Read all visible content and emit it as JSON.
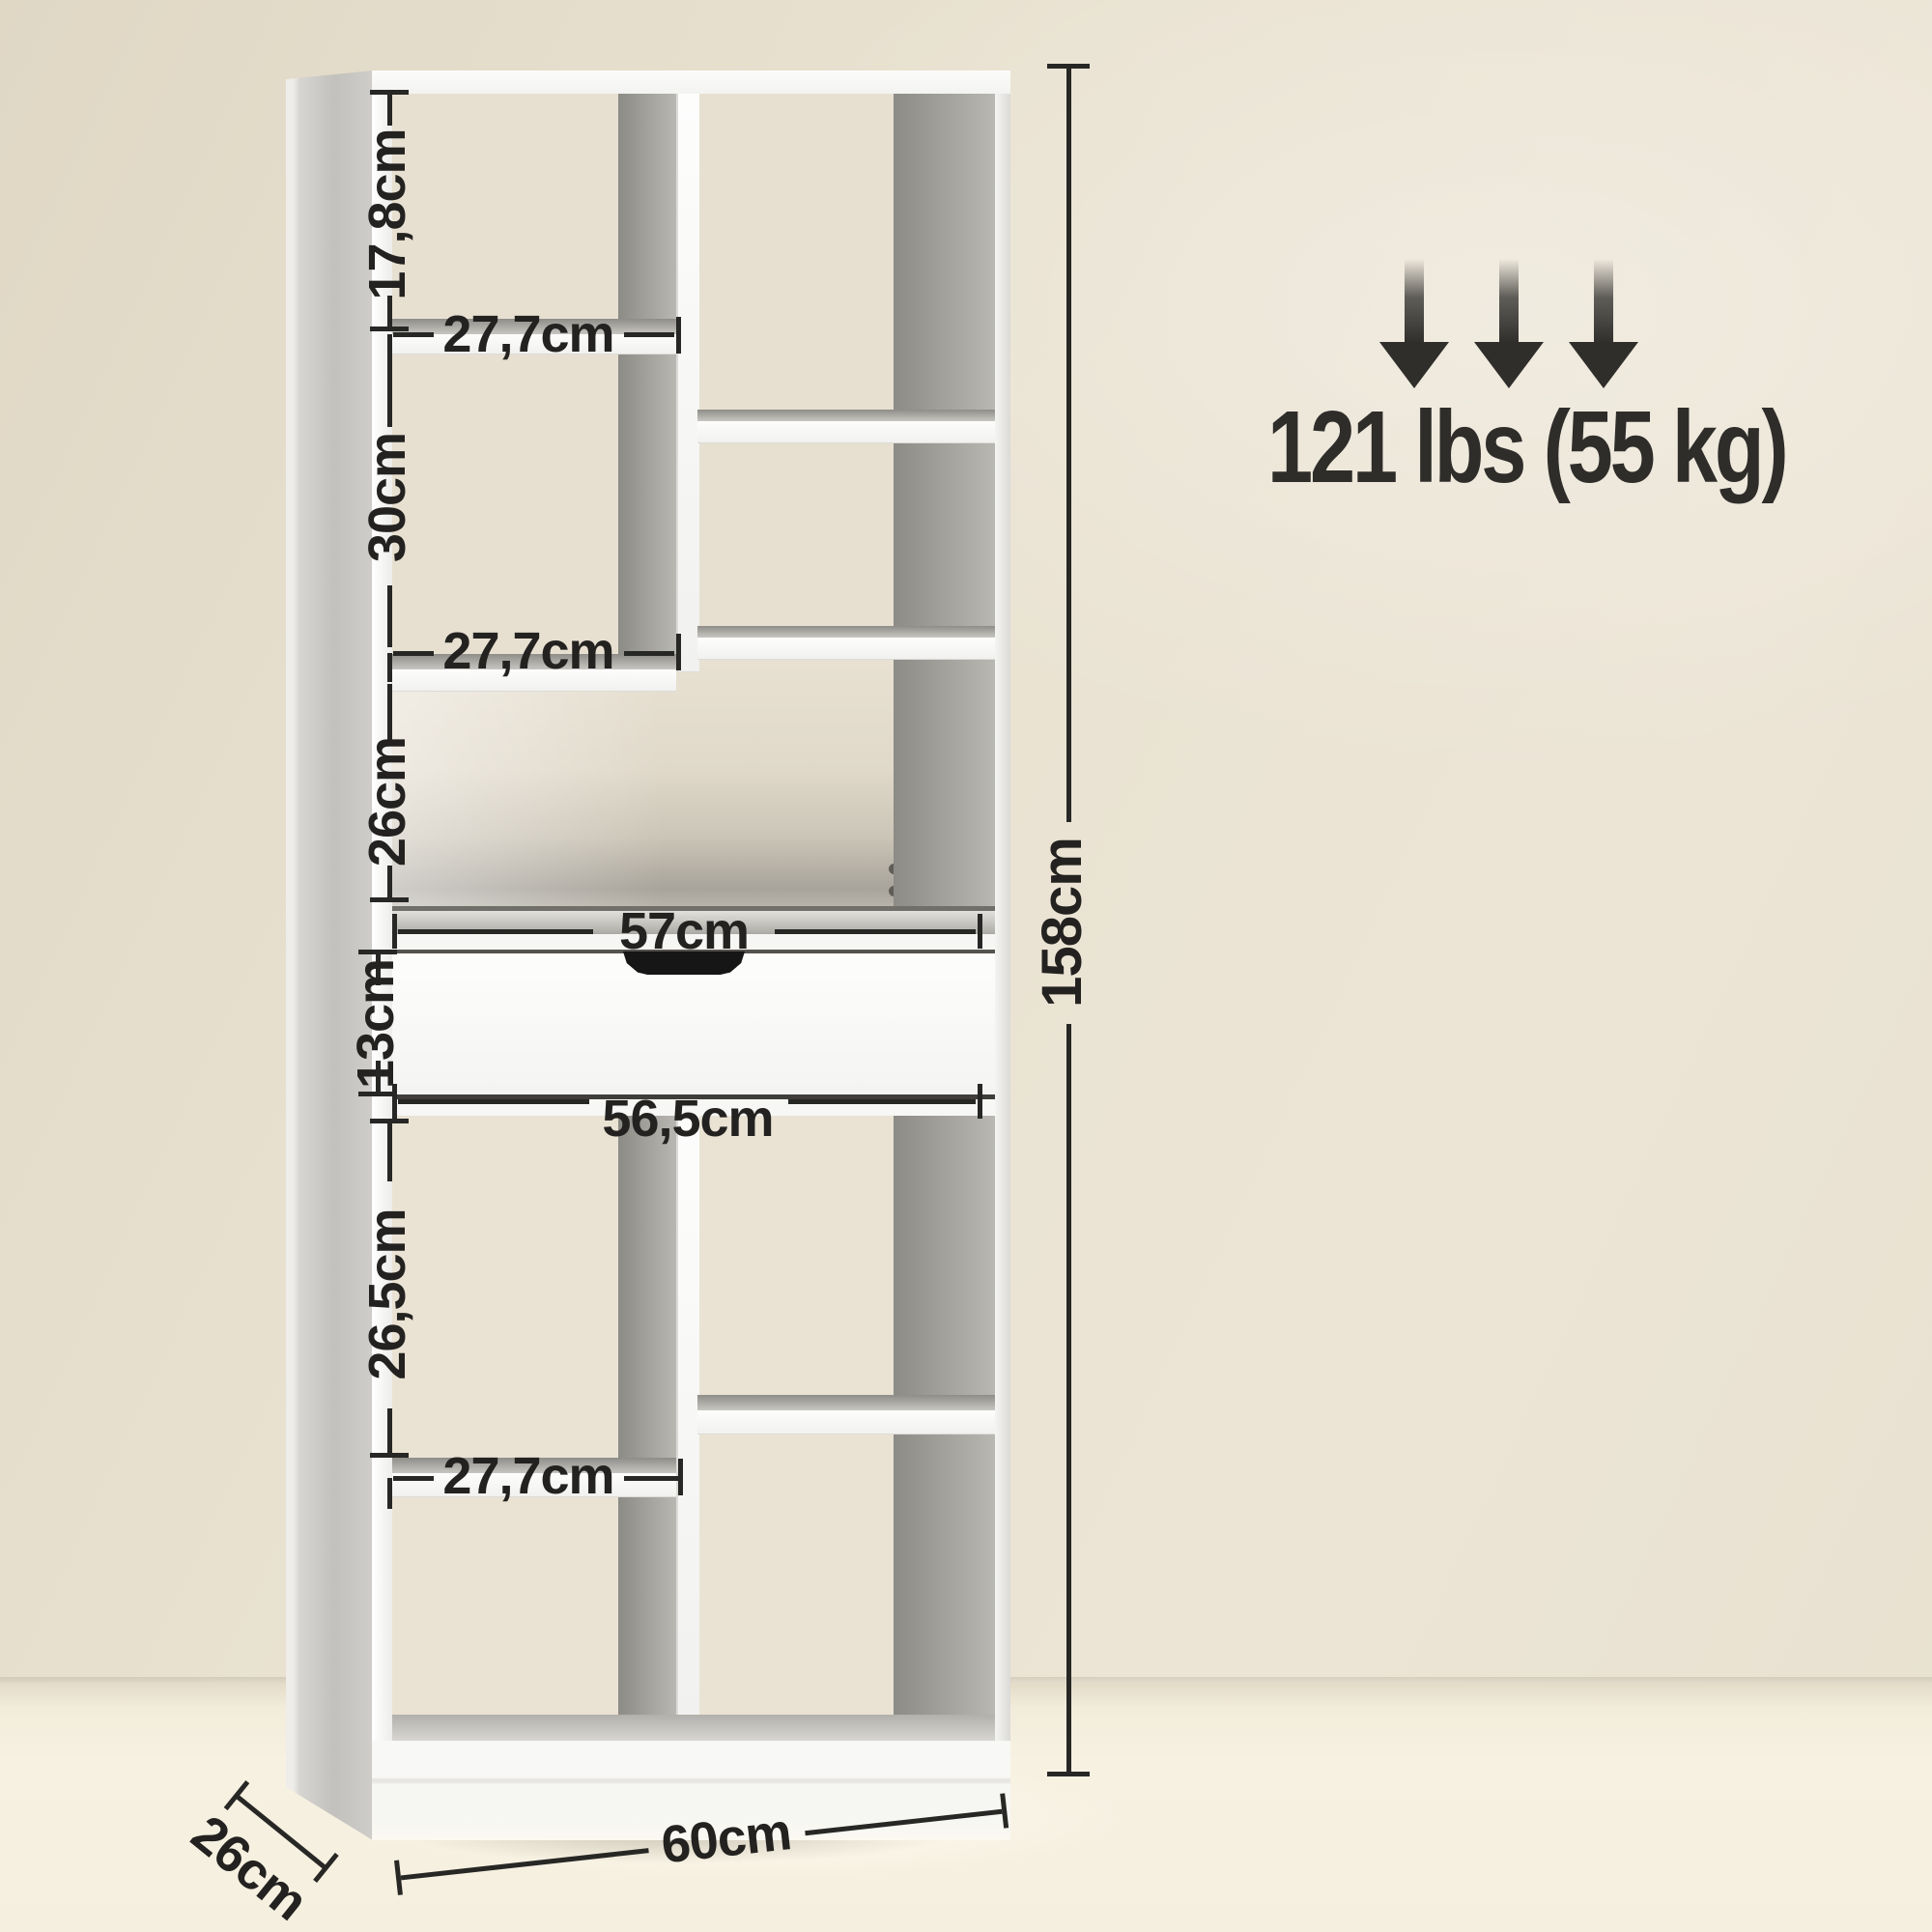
{
  "product": {
    "name": "bookcase with drawer — dimension diagram"
  },
  "capacity": {
    "label": "121 lbs (55 kg)",
    "arrow_icons": [
      "down-arrow-icon",
      "down-arrow-icon",
      "down-arrow-icon"
    ]
  },
  "dims": {
    "top_cell_height": "17,8cm",
    "upper_shelf_width": "27,7cm",
    "middle_cell_height": "30cm",
    "middle_shelf_width": "27,7cm",
    "open_compartment_height": "26cm",
    "counter_width": "57cm",
    "drawer_height": "13cm",
    "drawer_width": "56,5cm",
    "lower_cell_height": "26,5cm",
    "lower_shelf_width": "27,7cm",
    "overall_height": "158cm",
    "overall_width": "60cm",
    "overall_depth": "26cm"
  },
  "colors": {
    "wall": "#e9e2d1",
    "floor": "#f6f0e1",
    "unit_white": "#f7f7f5",
    "interior_back": "#e7e0d1",
    "interior_shadow": "#9b9994",
    "dimension_line": "#272725",
    "accent_text": "#2f2e2b"
  }
}
